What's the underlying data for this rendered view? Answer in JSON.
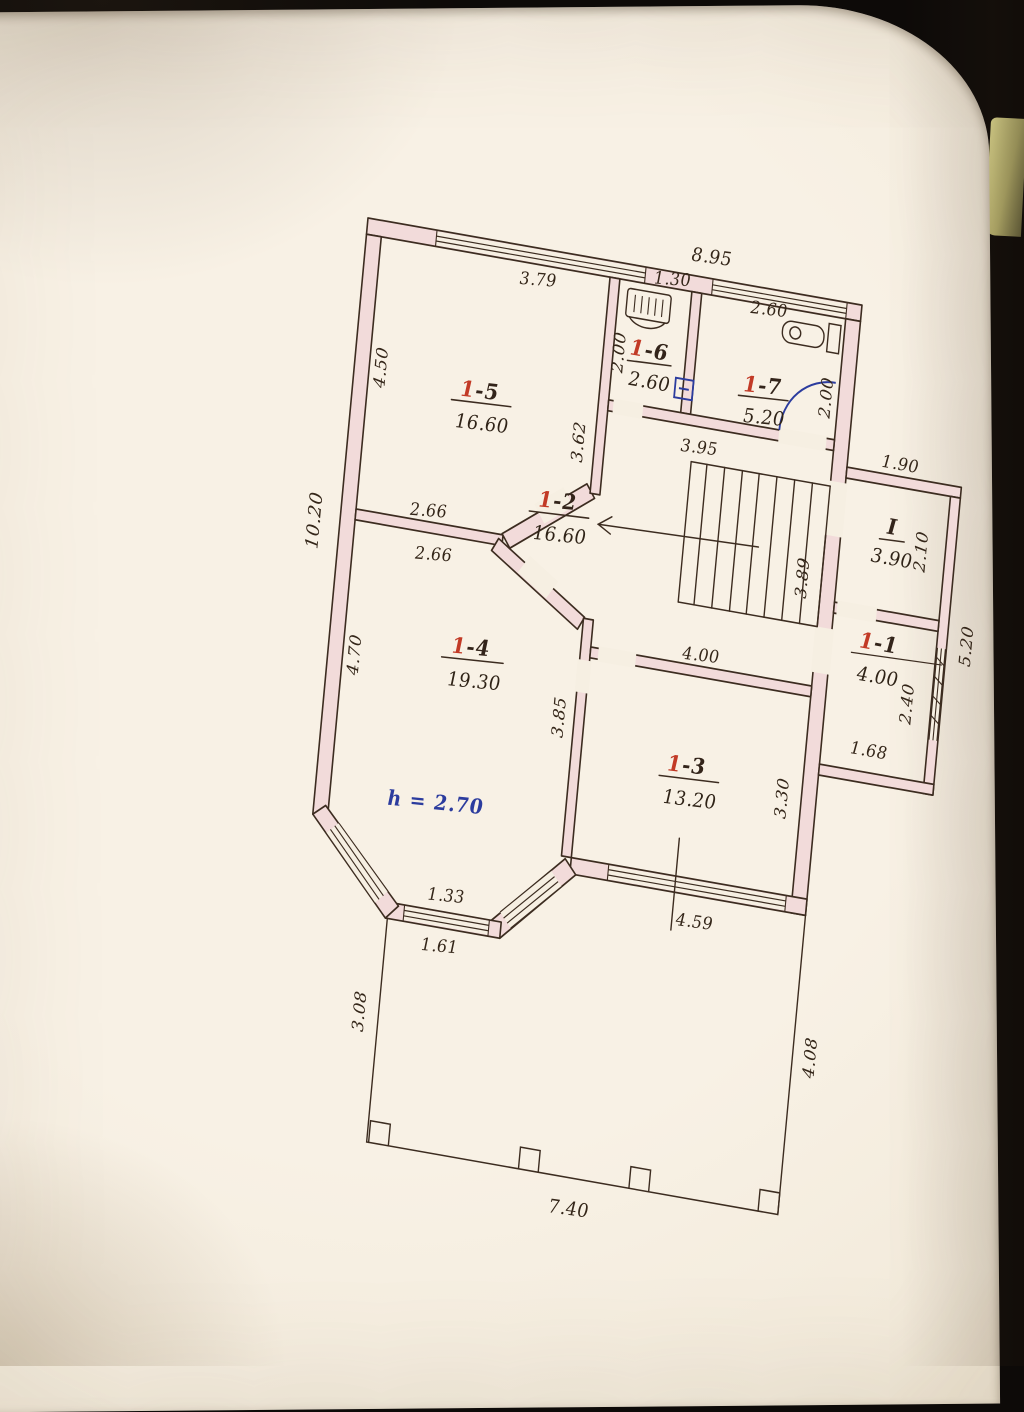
{
  "colors": {
    "paper": "#f6efe2",
    "ink": "#3c2c20",
    "wall_fill": "#f2dbda",
    "room_number_red": "#c23a26",
    "note_blue": "#2c3c9e"
  },
  "plan": {
    "rooms": {
      "r15": {
        "red": "1",
        "rest": "-5",
        "area": "16.60"
      },
      "r16": {
        "red": "1",
        "rest": "-6",
        "area": "2.60"
      },
      "r17": {
        "red": "1",
        "rest": "-7",
        "area": "5.20"
      },
      "r12": {
        "red": "1",
        "rest": "-2",
        "area": "16.60"
      },
      "rI": {
        "red": "I",
        "rest": "",
        "area": "3.90"
      },
      "r11": {
        "red": "1",
        "rest": "-1",
        "area": "4.00"
      },
      "r14": {
        "red": "1",
        "rest": "-4",
        "area": "19.30"
      },
      "r13": {
        "red": "1",
        "rest": "-3",
        "area": "13.20"
      }
    },
    "height_note": "h = 2.70",
    "dims": {
      "top_exterior": "8.95",
      "window_r15": "3.79",
      "left_r15": "4.50",
      "left_exterior": "10.20",
      "wall_r15_right": "3.62",
      "r16_width": "1.30",
      "r16_depth": "2.00",
      "window_r17": "2.60",
      "r17_depth": "2.00",
      "hall_top": "3.95",
      "wall_r14_top_upper": "2.66",
      "wall_r14_top_lower": "2.66",
      "left_r14": "4.70",
      "wall_r14_right": "3.85",
      "hall_right": "3.89",
      "r13_top": "4.00",
      "r13_right": "3.30",
      "window_r13": "4.59",
      "bay_window_inner": "1.33",
      "bay_window_outer": "1.61",
      "annex_top": "1.90",
      "roomI_side": "2.10",
      "annex_right": "5.20",
      "r11_side": "2.40",
      "r11_bottom": "1.68",
      "terrace_left": "3.08",
      "terrace_right": "4.08",
      "terrace_bottom": "7.40"
    }
  }
}
